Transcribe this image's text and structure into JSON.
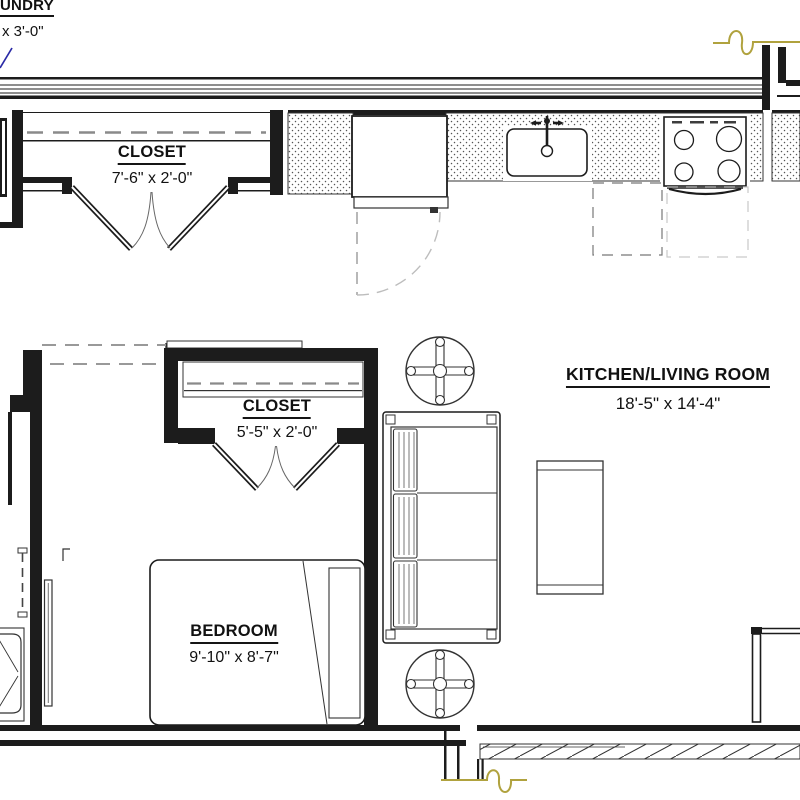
{
  "drawing": {
    "type": "architectural-floor-plan",
    "rooms": [
      {
        "id": "laundry",
        "name": "UNDRY",
        "dims": "x 3'-0\""
      },
      {
        "id": "closet-top",
        "name": "CLOSET",
        "dims": "7'-6\" x 2'-0\""
      },
      {
        "id": "closet-middle",
        "name": "CLOSET",
        "dims": "5'-5\" x 2'-0\""
      },
      {
        "id": "kitchen-living-room",
        "name": "KITCHEN/LIVING ROOM",
        "dims": "18'-5\" x 14'-4\""
      },
      {
        "id": "bedroom",
        "name": "BEDROOM",
        "dims": "9'-10\" x 8'-7\""
      }
    ],
    "fixtures": [
      "refrigerator",
      "kitchen-sink",
      "range-stove",
      "sofa",
      "coffee-table",
      "round-end-table-top",
      "round-end-table-bottom",
      "bed",
      "pillow",
      "shower",
      "pocket-door",
      "bifold-closet-doors",
      "balcony-deck",
      "patio-door"
    ],
    "colors": {
      "wall_line": "#1c1c1c",
      "detail_line": "#333333",
      "door_swing_dash": "#999999",
      "break_line": "#b0a23e",
      "leader_line": "#2a2aa6",
      "paper": "#ffffff"
    }
  }
}
